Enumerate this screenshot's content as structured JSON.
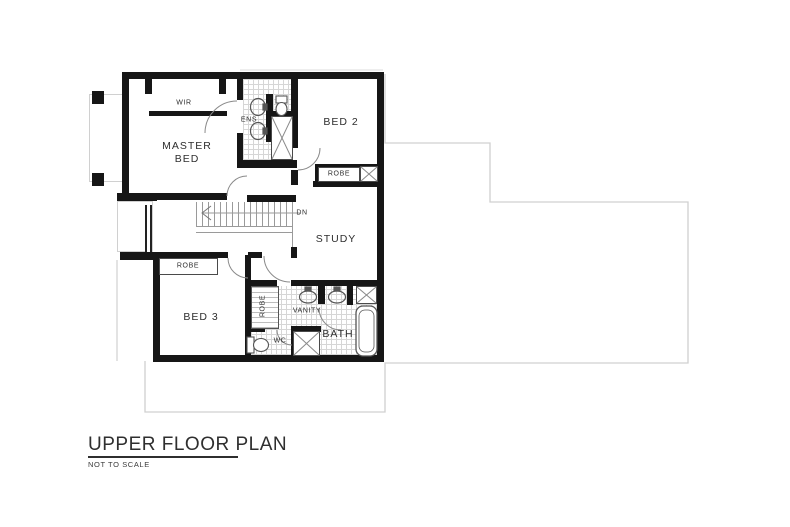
{
  "title": {
    "heading": "UPPER FLOOR PLAN",
    "note": "NOT TO SCALE"
  },
  "labels": {
    "wir": "WIR",
    "ens": "ENS",
    "bed2": "BED 2",
    "master_line1": "MASTER",
    "master_line2": "BED",
    "robe_bed2": "ROBE",
    "dn": "DN",
    "study": "STUDY",
    "robe_hall": "ROBE",
    "bed3": "BED 3",
    "robe_bath": "ROBE",
    "vanity": "VANITY",
    "wc": "WC",
    "bath": "BATH"
  },
  "colors": {
    "wall": "#161616",
    "tile_line": "#d6d6d6",
    "fixture_line": "#555555",
    "door_arc": "#8a8a8a",
    "ground_floor_outline": "#d0d0d0",
    "text": "#2e2e2e",
    "background": "#ffffff"
  }
}
